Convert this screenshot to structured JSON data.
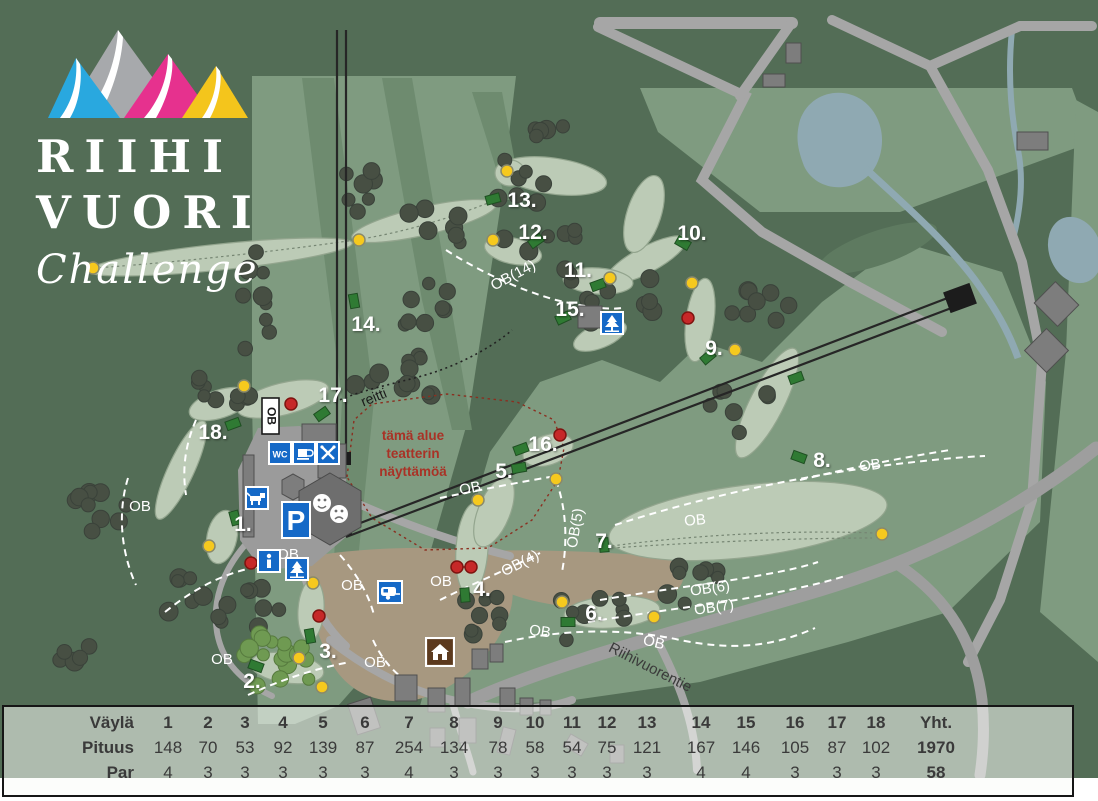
{
  "logo": {
    "line1": "RIIHI",
    "line2": "VUORI",
    "line3": "Challenge"
  },
  "map": {
    "hole_labels": [
      "1.",
      "2.",
      "3.",
      "4.",
      "5.",
      "6.",
      "7.",
      "8.",
      "9.",
      "10.",
      "11.",
      "12.",
      "13.",
      "14.",
      "15.",
      "16.",
      "17.",
      "18."
    ],
    "ob_labels": {
      "ob": "OB",
      "ob4": "OB(4)",
      "ob5": "OB(5)",
      "ob6": "OB(6)",
      "ob7": "OB(7)",
      "ob14": "OB(14)"
    },
    "ob_sign_label": "OB",
    "route_label": "reitti",
    "road_label": "Riihivuorentie",
    "theater_note_lines": [
      "tämä alue",
      "teatterin",
      "näyttämöä"
    ],
    "icon_text": {
      "wc": "WC",
      "parking": "P",
      "info": "i"
    },
    "icons": [
      "ob-sign-icon",
      "wc-icon",
      "cafe-icon",
      "restaurant-icon",
      "dog-icon",
      "parking-icon",
      "info-icon",
      "tree-icon",
      "tree-icon",
      "caravan-icon",
      "house-icon",
      "theater-masks-icon"
    ]
  },
  "table": {
    "header_label": "Väylä",
    "length_label": "Pituus",
    "par_label": "Par",
    "total_label": "Yht.",
    "holes": [
      "1",
      "2",
      "3",
      "4",
      "5",
      "6",
      "7",
      "8",
      "9",
      "10",
      "11",
      "12",
      "13",
      "14",
      "15",
      "16",
      "17",
      "18"
    ],
    "lengths": [
      148,
      70,
      53,
      92,
      139,
      87,
      254,
      134,
      78,
      58,
      54,
      75,
      121,
      167,
      146,
      105,
      87,
      102
    ],
    "pars": [
      4,
      3,
      3,
      3,
      3,
      3,
      4,
      3,
      3,
      3,
      3,
      3,
      3,
      4,
      4,
      3,
      3,
      3
    ],
    "total_length": "1970",
    "total_par": "58"
  },
  "colors": {
    "base_green": "#536d56",
    "open_green": "#7f9b80",
    "fairway": "#bccbb6",
    "tree": "#474f43",
    "path_gray": "#a6a6a6",
    "water": "#8fa9b2",
    "tan": "#a79880",
    "icon_blue": "#1569c7",
    "house_brown": "#5c3a1e",
    "basket_yellow": "#f6c91e",
    "marker_red": "#c62828",
    "tee_green": "#2f7a33",
    "note_red": "#a93226",
    "mountain_blue": "#29a8df",
    "mountain_gray": "#a7a9ac",
    "mountain_magenta": "#e6318e",
    "mountain_yellow": "#f4c51c"
  }
}
